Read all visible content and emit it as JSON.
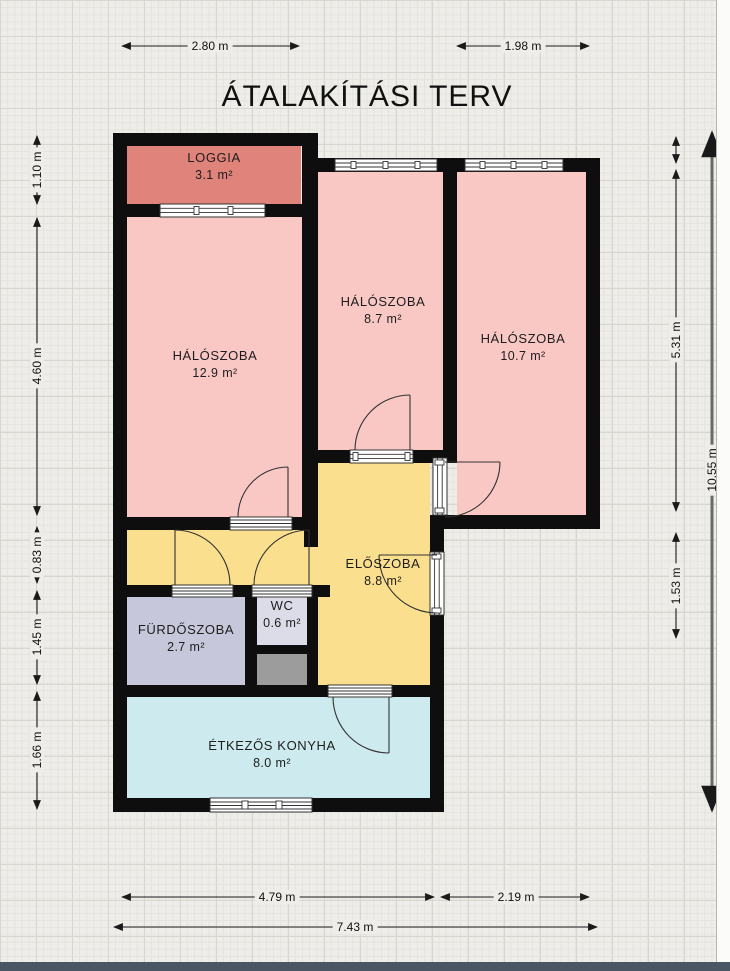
{
  "title": "ÁTALAKÍTÁSI TERV",
  "rooms": [
    {
      "name": "LOGGIA",
      "area": "3.1 m²"
    },
    {
      "name": "HÁLÓSZOBA",
      "area": "12.9 m²"
    },
    {
      "name": "HÁLÓSZOBA",
      "area": "8.7 m²"
    },
    {
      "name": "HÁLÓSZOBA",
      "area": "10.7 m²"
    },
    {
      "name": "ELŐSZOBA",
      "area": "8.8 m²"
    },
    {
      "name": "FÜRDŐSZOBA",
      "area": "2.7 m²"
    },
    {
      "name": "WC",
      "area": "0.6 m²"
    },
    {
      "name": "ÉTKEZŐS KONYHA",
      "area": "8.0 m²"
    }
  ],
  "dimensions": {
    "top": [
      "2.80 m",
      "1.98 m"
    ],
    "bottom": [
      "4.79 m",
      "2.19 m",
      "7.43 m"
    ],
    "left": [
      "1.10 m",
      "4.60 m",
      "0.83 m",
      "1.45 m",
      "1.66 m"
    ],
    "right": [
      "5.31 m",
      "1.53 m",
      "10.55 m"
    ]
  },
  "colors": {
    "wall": "#0e0e0e",
    "loggia": "#e0837a",
    "bedroom": "#f9c8c5",
    "hall": "#fadf8e",
    "bathroom": "#c7c7db",
    "wc": "#dcdce8",
    "shaft": "#9c9c9c",
    "kitchen": "#cdeaee"
  }
}
